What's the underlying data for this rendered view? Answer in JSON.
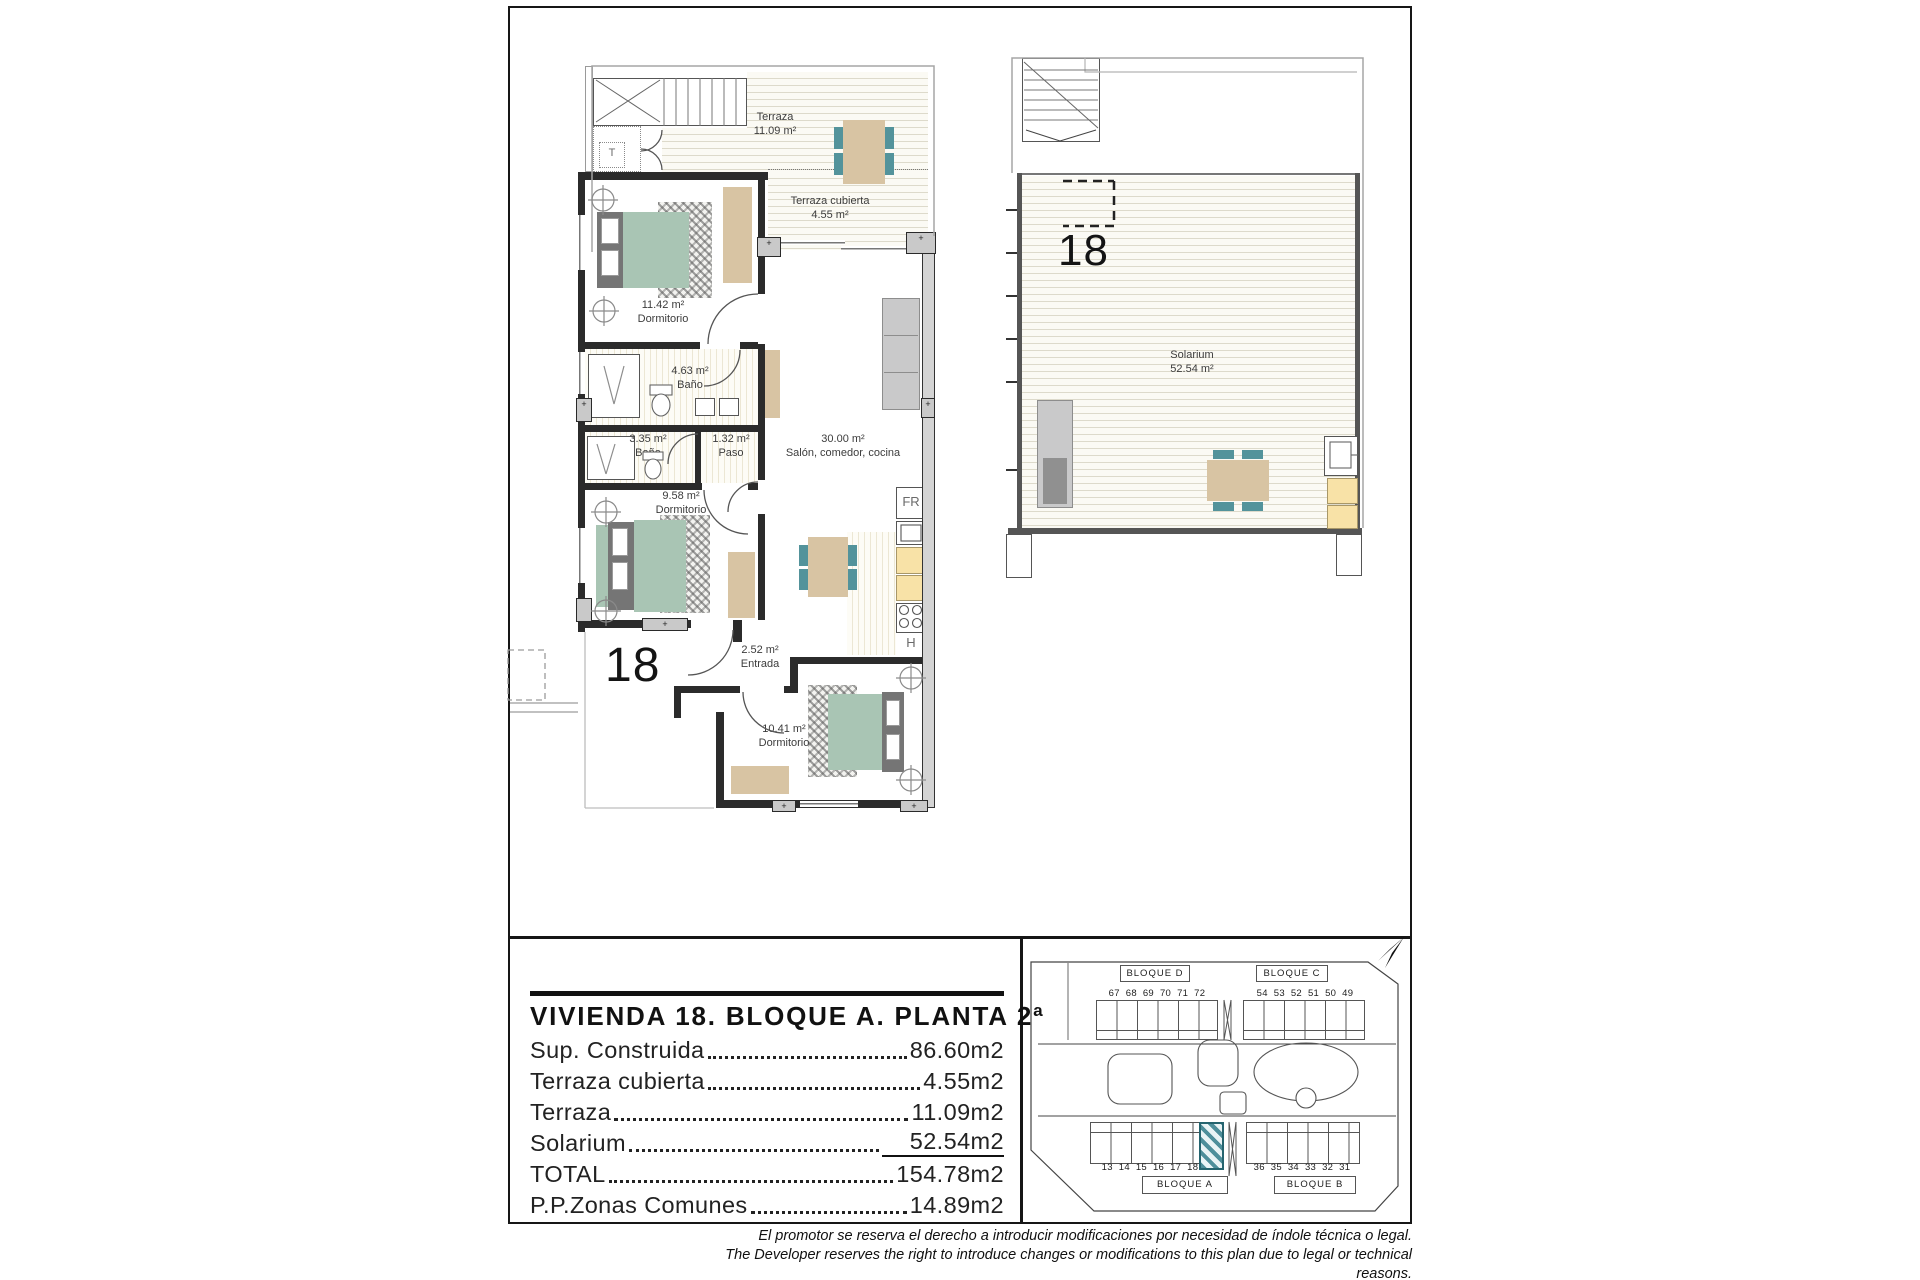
{
  "plan_main": {
    "unit_number": "18",
    "rooms": [
      {
        "label": "Terraza",
        "area": "11.09 m²"
      },
      {
        "label": "Terraza cubierta",
        "area": "4.55 m²"
      },
      {
        "area": "11.42 m²",
        "label": "Dormitorio"
      },
      {
        "area": "4.63 m²",
        "label": "Baño"
      },
      {
        "area": "3.35 m²",
        "label": "Baño"
      },
      {
        "area": "1.32 m²",
        "label": "Paso"
      },
      {
        "area": "30.00 m²",
        "label": "Salón, comedor, cocina"
      },
      {
        "area": "9.58 m²",
        "label": "Dormitorio"
      },
      {
        "area": "2.52 m²",
        "label": "Entrada"
      },
      {
        "area": "10.41 m²",
        "label": "Dormitorio"
      }
    ],
    "markers": {
      "stairs": "T",
      "fridge": "FR",
      "hob": "H"
    }
  },
  "plan_solarium": {
    "unit_number": "18",
    "label": "Solarium",
    "area": "52.54 m²"
  },
  "legend": {
    "title": "VIVIENDA 18. BLOQUE A. PLANTA 2ª",
    "rows": [
      {
        "label": "Sup. Construida",
        "value": "86.60m2"
      },
      {
        "label": "Terraza cubierta",
        "value": "4.55m2"
      },
      {
        "label": "Terraza",
        "value": "11.09m2"
      },
      {
        "label": "Solarium",
        "value": "52.54m2"
      },
      {
        "label": "TOTAL",
        "value": "154.78m2"
      },
      {
        "label": "P.P.Zonas Comunes",
        "value": "14.89m2"
      }
    ]
  },
  "site_plan": {
    "highlighted_unit": "18",
    "blocks": [
      {
        "name": "BLOQUE D",
        "units": "67 68 69 70 71 72"
      },
      {
        "name": "BLOQUE C",
        "units": "54 53 52 51 50 49"
      },
      {
        "name": "BLOQUE A",
        "units": "13 14 15 16 17 18"
      },
      {
        "name": "BLOQUE B",
        "units": "36 35 34 33 32 31"
      }
    ]
  },
  "disclaimer": {
    "es": "El promotor se reserva el derecho a introducir modificaciones por necesidad de índole técnica o legal.",
    "en": "The Developer reserves the right to introduce changes or modifications to this plan due to legal or technical reasons."
  },
  "colors": {
    "wall": "#2b2b2b",
    "furniture_teal": "#53939b",
    "furniture_sage": "#a9c5b4",
    "furniture_tan": "#d8c4a3",
    "counter_yellow": "#f8e2a7",
    "highlight_hatch": "#4e8f9b"
  }
}
